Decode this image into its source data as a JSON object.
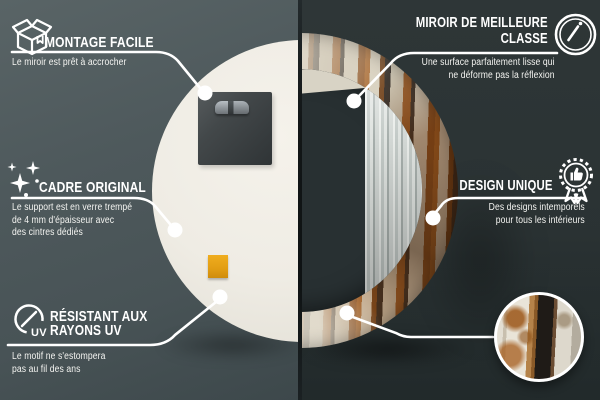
{
  "callouts": {
    "montage": {
      "title": "MONTAGE FACILE",
      "desc": "Le miroir est prêt à accrocher",
      "icon": "package-icon"
    },
    "quality": {
      "title_line1": "MIROIR DE MEILLEURE",
      "title_line2": "CLASSE",
      "desc_line1": "Une surface parfaitement lisse qui",
      "desc_line2": "ne déforme pas la réflexion",
      "icon": "mirror-shine-icon"
    },
    "frame": {
      "title": "CADRE ORIGINAL",
      "desc_line1": "Le support est en verre trempé",
      "desc_line2": "de 4 mm d'épaisseur avec",
      "desc_line3": "des cintres dédiés",
      "icon": "sparkles-icon"
    },
    "design": {
      "title": "DESIGN UNIQUE",
      "desc_line1": "Des designs intemporels",
      "desc_line2": "pour tous les intérieurs",
      "icon": "award-badge-icon"
    },
    "uv": {
      "title_line1": "RÉSISTANT AUX",
      "title_line2": "RAYONS UV",
      "desc_line1": "Le motif ne s'estompera",
      "desc_line2": "pas au fil des ans",
      "icon": "uv-protection-icon",
      "icon_label": "UV"
    }
  },
  "colors": {
    "background_left": "#4e595c",
    "background_right": "#2b3334",
    "callout_accent": "#ffffff",
    "mirror_back": "#efece4",
    "sticker_orange": "#e8a11c",
    "wood_rust": "#8a4c1b",
    "wood_paint": "#d9d2c1"
  }
}
